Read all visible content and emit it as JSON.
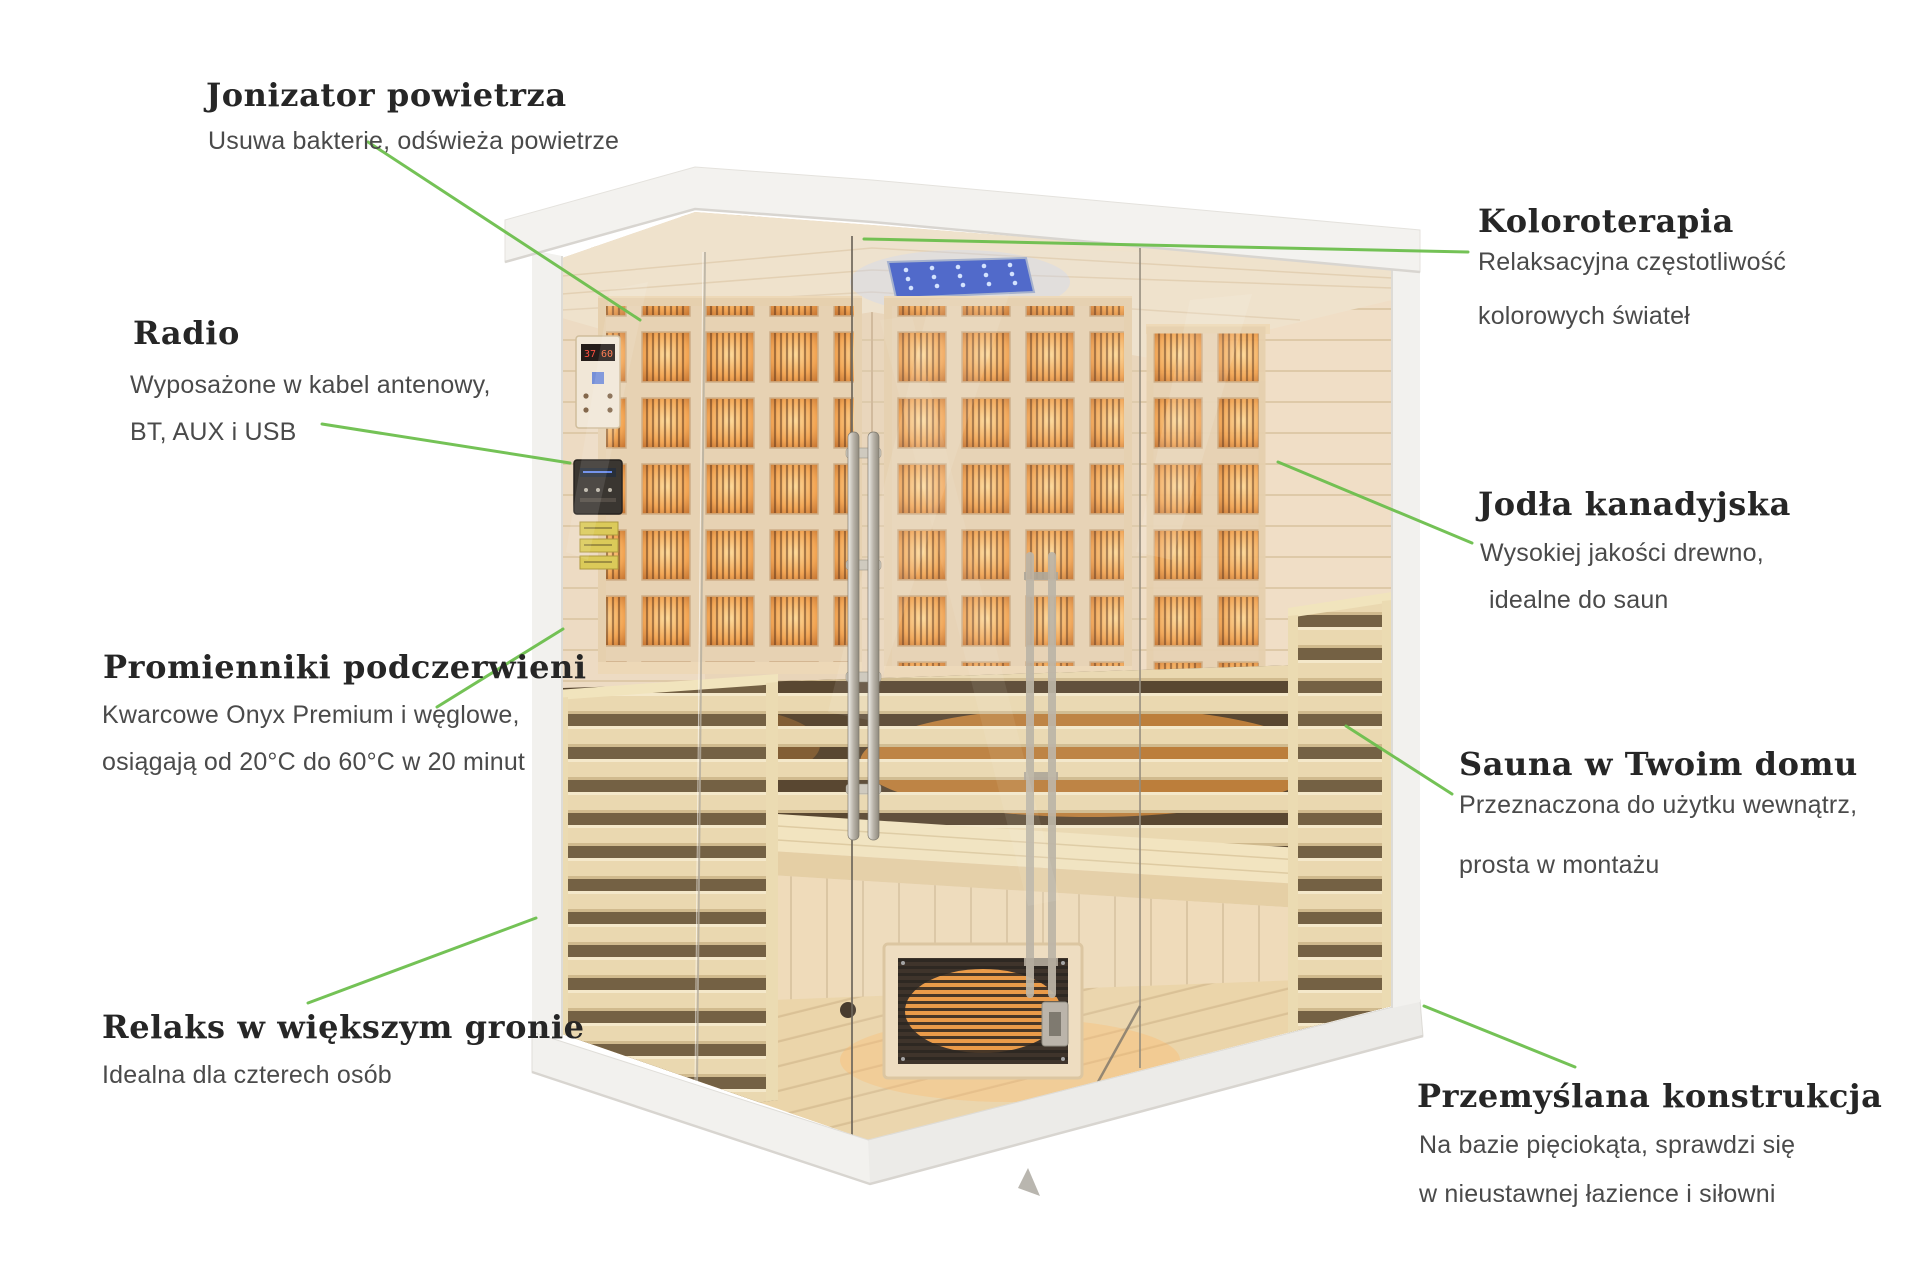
{
  "page": {
    "background": "#ffffff"
  },
  "colors": {
    "heading": "#262626",
    "body": "#4a4a4a",
    "accent": "#6dbf4d",
    "glow": "#ff9c35",
    "wood": "#ecd9bd",
    "frame": "#f2f1ee",
    "led": "#3b57c4"
  },
  "annotations": {
    "jonizator": {
      "heading": "Jonizator powietrza",
      "line1": "Usuwa bakterie, odświeża powietrze"
    },
    "radio": {
      "heading": "Radio",
      "line1": "Wyposażone w kabel antenowy,",
      "line2": "BT, AUX i USB"
    },
    "promienniki": {
      "heading": "Promienniki podczerwieni",
      "line1": "Kwarcowe Onyx Premium i węglowe,",
      "line2": "osiągają od 20°C do 60°C w 20 minut"
    },
    "relaks": {
      "heading": "Relaks w większym gronie",
      "line1": "Idealna dla czterech osób"
    },
    "koloroterapia": {
      "heading": "Koloroterapia",
      "line1": "Relaksacyjna częstotliwość",
      "line2": "kolorowych świateł"
    },
    "jodla": {
      "heading": "Jodła kanadyjska",
      "line1": "Wysokiej jakości drewno,",
      "line2": "idealne do saun"
    },
    "sauna_domu": {
      "heading": "Sauna w Twoim domu",
      "line1": "Przeznaczona do użytku wewnątrz,",
      "line2": "prosta w montażu"
    },
    "konstrukcja": {
      "heading": "Przemyślana konstrukcja",
      "line1": "Na bazie pięciokąta, sprawdzi się",
      "line2": "w nieustawnej łazience i siłowni"
    }
  },
  "control_display": {
    "temperature": "37",
    "setting": "60"
  }
}
